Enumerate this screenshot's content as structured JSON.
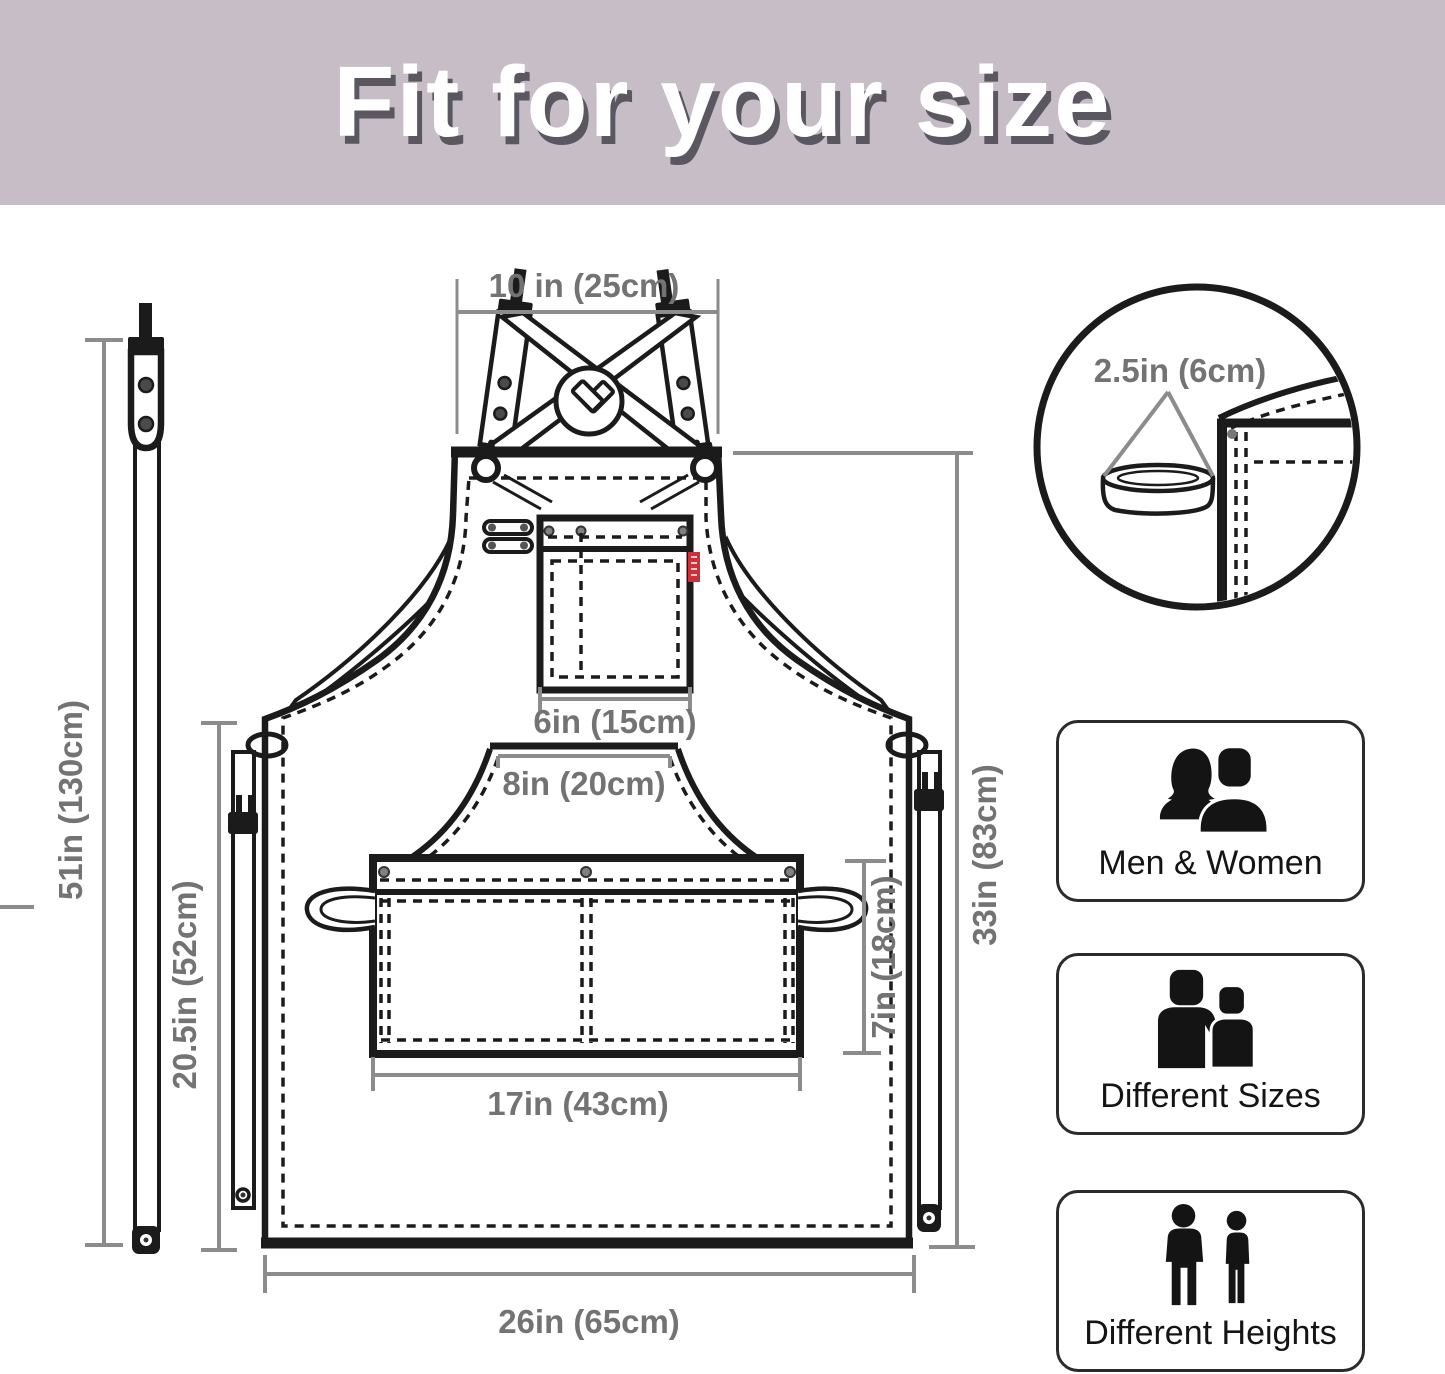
{
  "title": "Fit for your size",
  "colors": {
    "banner_bg": "#c6bdc7",
    "title_text": "#ffffff",
    "title_shadow": "#5a5760",
    "drawing_line": "#1b1b1b",
    "dimension_line": "#8c8c8c",
    "dimension_text": "#737373",
    "pocket_tag_red": "#cf3038"
  },
  "diagram": {
    "measurements": {
      "neck_strap_width": "10 in (25cm)",
      "strap_length": "51in (130cm)",
      "side_length": "20.5in (52cm)",
      "apron_length": "33in (83cm)",
      "chest_pocket_width": "6in (15cm)",
      "waist_panel_width": "8in (20cm)",
      "front_pocket_width": "17in (43cm)",
      "front_pocket_height": "7in (18cm)",
      "bottom_width": "26in (65cm)",
      "towel_loop_width": "2.5in (6cm)"
    }
  },
  "features": [
    {
      "label": "Men & Women"
    },
    {
      "label": "Different Sizes"
    },
    {
      "label": "Different Heights"
    }
  ]
}
